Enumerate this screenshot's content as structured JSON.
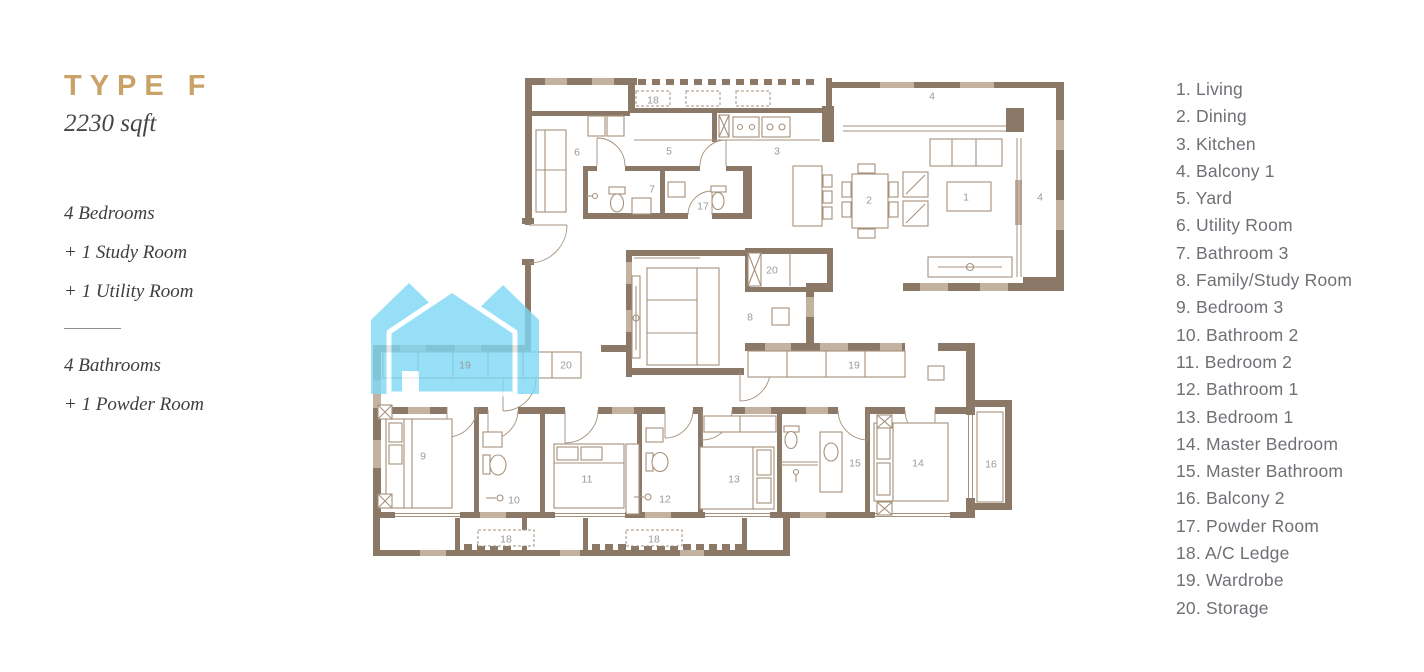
{
  "title_block": {
    "type_label": "TYPE F",
    "area": "2230 sqft",
    "features_top": [
      "4 Bedrooms",
      "+ 1 Study Room",
      "+ 1 Utility Room"
    ],
    "features_bottom": [
      "4 Bathrooms",
      "+ 1 Powder Room"
    ]
  },
  "legend": {
    "items": [
      "1. Living",
      "2. Dining",
      "3. Kitchen",
      "4. Balcony 1",
      "5. Yard",
      "6. Utility Room",
      "7. Bathroom 3",
      "8. Family/Study Room",
      "9. Bedroom 3",
      "10. Bathroom 2",
      "11. Bedroom 2",
      "12. Bathroom 1",
      "13. Bedroom 1",
      "14. Master Bedroom",
      "15. Master Bathroom",
      "16. Balcony 2",
      "17. Powder Room",
      "18. A/C Ledge",
      "19. Wardrobe",
      "20. Storage"
    ]
  },
  "plan": {
    "room_labels": [
      {
        "t": "1",
        "x": 966,
        "y": 197
      },
      {
        "t": "2",
        "x": 869,
        "y": 200
      },
      {
        "t": "3",
        "x": 777,
        "y": 151
      },
      {
        "t": "4",
        "x": 932,
        "y": 96
      },
      {
        "t": "4",
        "x": 1040,
        "y": 197
      },
      {
        "t": "5",
        "x": 669,
        "y": 151
      },
      {
        "t": "6",
        "x": 577,
        "y": 152
      },
      {
        "t": "7",
        "x": 652,
        "y": 189
      },
      {
        "t": "8",
        "x": 750,
        "y": 317
      },
      {
        "t": "9",
        "x": 423,
        "y": 456
      },
      {
        "t": "10",
        "x": 514,
        "y": 500
      },
      {
        "t": "11",
        "x": 587,
        "y": 479
      },
      {
        "t": "12",
        "x": 665,
        "y": 499
      },
      {
        "t": "13",
        "x": 734,
        "y": 479
      },
      {
        "t": "14",
        "x": 918,
        "y": 463
      },
      {
        "t": "15",
        "x": 855,
        "y": 463
      },
      {
        "t": "16",
        "x": 991,
        "y": 464
      },
      {
        "t": "17",
        "x": 703,
        "y": 206
      },
      {
        "t": "18",
        "x": 653,
        "y": 100
      },
      {
        "t": "18",
        "x": 506,
        "y": 539
      },
      {
        "t": "18",
        "x": 654,
        "y": 539
      },
      {
        "t": "19",
        "x": 465,
        "y": 365
      },
      {
        "t": "19",
        "x": 854,
        "y": 365
      },
      {
        "t": "20",
        "x": 772,
        "y": 270
      },
      {
        "t": "20",
        "x": 566,
        "y": 365
      }
    ],
    "colors": {
      "wall": "#8b7867",
      "wall_light": "#c3b29f",
      "furniture": "#a5907b",
      "plan_label": "#9a9a96",
      "watermark": "#7ed8f4",
      "accent_gold": "#c8a266"
    }
  }
}
